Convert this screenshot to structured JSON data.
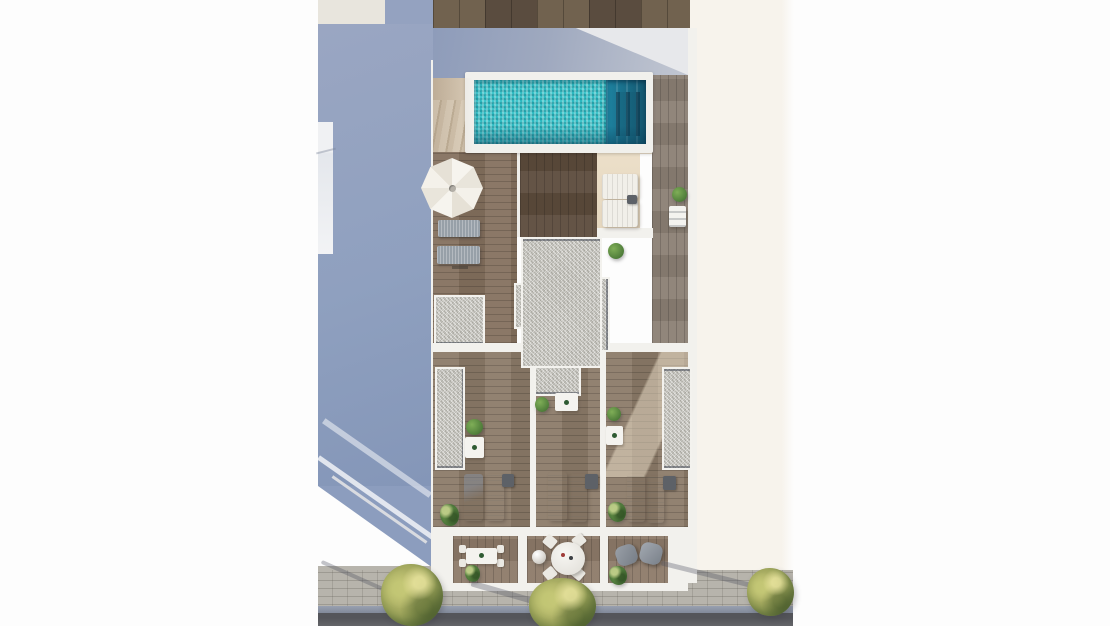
{
  "meta": {
    "domain": "architectural-visualization",
    "description": "Aerial top-down 3D render of a residential building rooftop floor plan: swimming pool with turquoise mosaic water, white parasol, sun loungers, wooden decks, gravel roof panels, three private terraces, lower patios with dining furniture, and a street with trees; a large blue-grey building shadow falls on the left.",
    "no_visible_text": true
  },
  "palette": {
    "background": "#fdfdfd",
    "shadow_blue": "#8fa0bf",
    "roof_shadow_grey": "#9aa6bd",
    "pool_water_bright": "#2bb7bf",
    "pool_water_deep": "#14566e",
    "pool_surround": "#f1f0ec",
    "wood_deck_brown": "#84705e",
    "wood_dark_patch": "#5c4b3c",
    "wood_terrace": "#8b7a68",
    "wood_strip_grey": "#8b7f74",
    "top_roof_wood": "#695b4b",
    "gravel_grey": "#d2d1cb",
    "sand_floor": "#e8dcc8",
    "wall_white": "#f2f1ed",
    "cream_ground": "#f7f3ec",
    "sidewalk_grey": "#b7b4ac",
    "curb_blue_grey": "#8d96a8",
    "street_asphalt": "#57585c",
    "tree_green": "#a0a85c",
    "bush_green": "#4f7d3a",
    "parasol_white": "#f4f1ea",
    "lounger_grey": "#97a0a8",
    "accent_navy_edge": "#2c3442"
  },
  "scene": {
    "areas": [
      {
        "name": "neighbor-roof-strip",
        "material": "dark wood planks",
        "position": "top"
      },
      {
        "name": "building-shadow",
        "material": "blue-grey shade on neighbor wall",
        "position": "left"
      },
      {
        "name": "rooftop-pool-terrace",
        "features": [
          "swimming-pool",
          "stairs",
          "parasol",
          "sun-loungers",
          "wood-deck"
        ]
      },
      {
        "name": "gravel-roof-core",
        "shape": "cross with tabs",
        "position": "center"
      },
      {
        "name": "private-terraces",
        "count": 3,
        "features": [
          "wood floor",
          "plants",
          "bistro table",
          "two white loungers each"
        ]
      },
      {
        "name": "lower-patios",
        "count": 3,
        "features": [
          "dining table",
          "round table with four chairs",
          "two grey lounge chairs"
        ]
      },
      {
        "name": "street-front",
        "features": [
          "paved sidewalk",
          "trees",
          "curb",
          "asphalt road"
        ]
      },
      {
        "name": "neighbor-ground",
        "material": "cream paving",
        "position": "right"
      }
    ],
    "furniture_counts": {
      "parasols": 1,
      "grey_roof_loungers": 2,
      "white_pool_loungers": 2,
      "terrace_loungers": 6,
      "bistro_tables": 4,
      "dining_tables": 1,
      "round_tables": 1,
      "grey_armchairs": 2,
      "sphere_lamp": 1
    },
    "vegetation": {
      "street_trees": 3,
      "potted_bushes": 9
    },
    "pool": {
      "water_color": "turquoise mosaic",
      "deep_end": "right side with steps",
      "surround": "white"
    }
  }
}
